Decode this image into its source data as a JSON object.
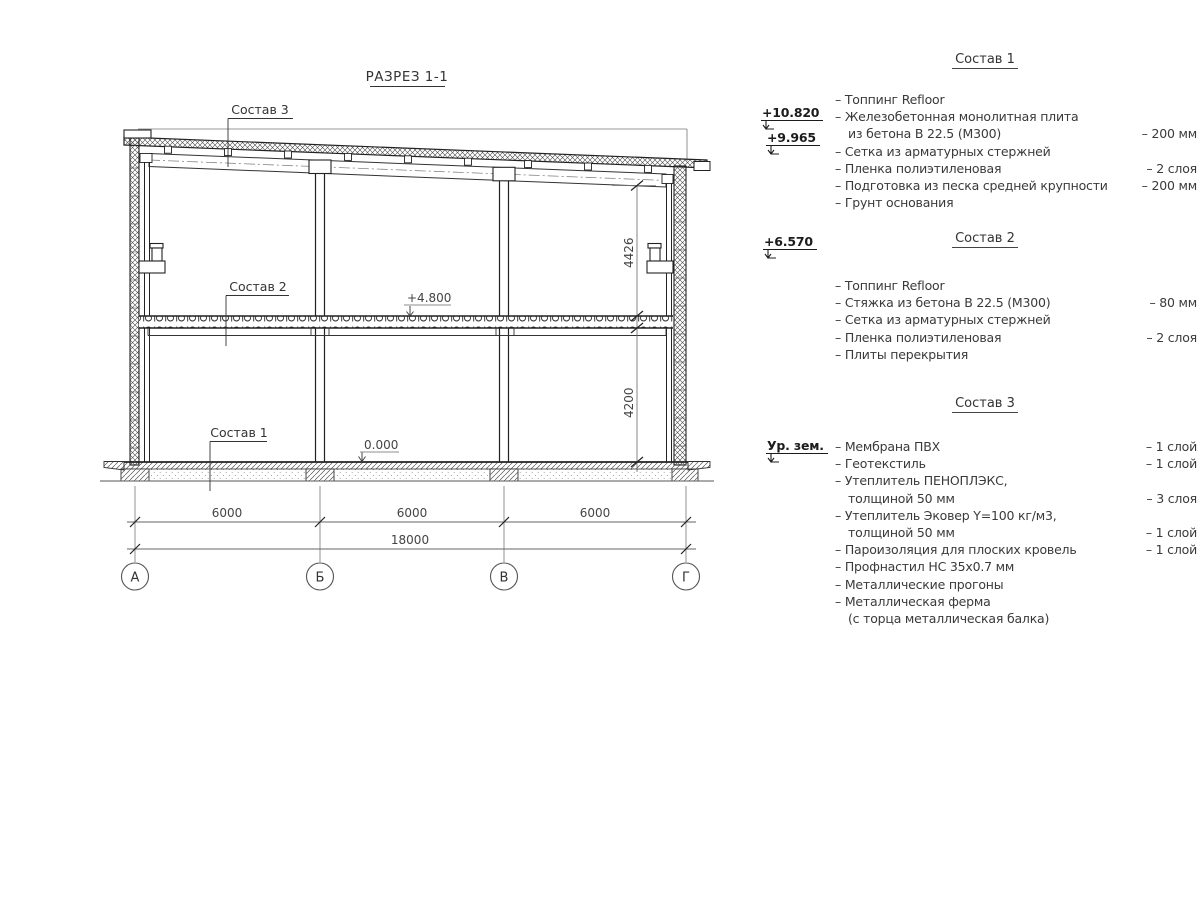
{
  "title": "РАЗРЕЗ 1-1",
  "drawing": {
    "section_labels": {
      "s3": "Состав 3",
      "s2": "Состав 2",
      "s1": "Состав 1"
    },
    "elevations": {
      "mid": "+4.800",
      "floor": "0.000"
    },
    "dims": {
      "spans": [
        "6000",
        "6000",
        "6000"
      ],
      "total": "18000",
      "upper": "4426",
      "lower": "4200"
    },
    "axes": [
      "А",
      "Б",
      "В",
      "Г"
    ]
  },
  "elevation_marks": [
    {
      "value": "+10.820"
    },
    {
      "value": "+9.965"
    },
    {
      "value": "+6.570"
    },
    {
      "value": "Ур. зем."
    }
  ],
  "compositions": [
    {
      "header": "Состав 1",
      "rows": [
        {
          "text": "– Топпинг Refloor",
          "qty": ""
        },
        {
          "text": "– Железобетонная  монолитная плита",
          "qty": ""
        },
        {
          "text": "из бетона В 22.5 (М300)",
          "qty": "– 200 мм",
          "indent": true
        },
        {
          "text": "– Сетка из арматурных стержней",
          "qty": ""
        },
        {
          "text": "– Пленка полиэтиленовая",
          "qty": "– 2 слоя"
        },
        {
          "text": "– Подготовка из песка средней крупности",
          "qty": "– 200 мм"
        },
        {
          "text": "– Грунт основания",
          "qty": ""
        }
      ]
    },
    {
      "header": "Состав 2",
      "rows": [
        {
          "text": "– Топпинг Refloor",
          "qty": ""
        },
        {
          "text": "– Стяжка из бетона В 22.5 (М300)",
          "qty": "– 80 мм"
        },
        {
          "text": "– Сетка из арматурных стержней",
          "qty": ""
        },
        {
          "text": "– Пленка полиэтиленовая",
          "qty": "– 2 слоя"
        },
        {
          "text": "– Плиты перекрытия",
          "qty": ""
        }
      ]
    },
    {
      "header": "Состав 3",
      "rows": [
        {
          "text": "– Мембрана ПВХ",
          "qty": "– 1 слой"
        },
        {
          "text": "– Геотекстиль",
          "qty": "– 1 слой"
        },
        {
          "text": "– Утеплитель ПЕНОПЛЭКС,",
          "qty": ""
        },
        {
          "text": "толщиной 50 мм",
          "qty": "– 3 слоя",
          "indent": true
        },
        {
          "text": "– Утеплитель Эковер Y=100 кг/м3,",
          "qty": ""
        },
        {
          "text": "толщиной 50 мм",
          "qty": "– 1 слой",
          "indent": true
        },
        {
          "text": "– Пароизоляция для плоских кровель",
          "qty": "– 1 слой"
        },
        {
          "text": "– Профнастил НС 35х0.7 мм",
          "qty": ""
        },
        {
          "text": "– Металлические прогоны",
          "qty": ""
        },
        {
          "text": "– Металлическая ферма",
          "qty": ""
        },
        {
          "text": "(с торца металлическая балка)",
          "qty": "",
          "indent": true
        }
      ]
    }
  ],
  "colors": {
    "line": "#222222",
    "dim": "#555555",
    "text": "#333333",
    "background": "#ffffff"
  }
}
